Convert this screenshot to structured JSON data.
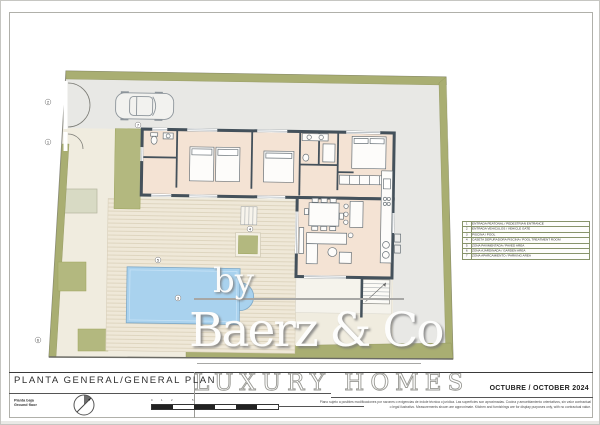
{
  "title_block": {
    "main_title": "PLANTA GENERAL/GENERAL PLAN",
    "floor_line1": "Planta baja",
    "floor_line2": "Ground floor",
    "date": "OCTUBRE / OCTOBER 2024"
  },
  "brand": {
    "pre": "by",
    "name": "Baerz & Co",
    "tagline": "LUXURY HOMES"
  },
  "legend": {
    "rows": [
      {
        "num": "1",
        "label": "ENTRADA PEATONAL / PEDESTRIAN ENTRANCE"
      },
      {
        "num": "2",
        "label": "ENTRADA VEHICULOS / VEHICLE GATE"
      },
      {
        "num": "3",
        "label": "PISCINA / POOL"
      },
      {
        "num": "4",
        "label": "CASETA DEPURADORA PISCINA / POOL TREATMENT ROOM"
      },
      {
        "num": "5",
        "label": "ZONA PAVIMENTADA / PAVED AREA"
      },
      {
        "num": "6",
        "label": "ZONA AJARDINADA / GARDEN AREA"
      },
      {
        "num": "7",
        "label": "ZONA APARCAMIENTO / PARKING AREA"
      }
    ]
  },
  "disclaimer": {
    "line1": "Plano sujeto a posibles modificaciones por razones o exigencias de índole técnica o jurídica. Las superficies son aproximadas. Cocina y amueblamiento orientativos, sin valor contractual",
    "line2": "o legal ilustrativo. Measurements shown are approximate. Kitchen and furnishings are for display purposes only, with no contractual value."
  },
  "scale_bar": {
    "labels": [
      "0",
      "1",
      "2",
      "5"
    ]
  },
  "colors": {
    "hedge_olive": "#a9ae72",
    "planter_olive": "#b3b87f",
    "garden_cream": "#f0ecdf",
    "paving_gray": "#e8e8e5",
    "house_fill": "#f4e3d4",
    "wall_dark": "#44515b",
    "pool_blue": "#a9d2ee"
  }
}
